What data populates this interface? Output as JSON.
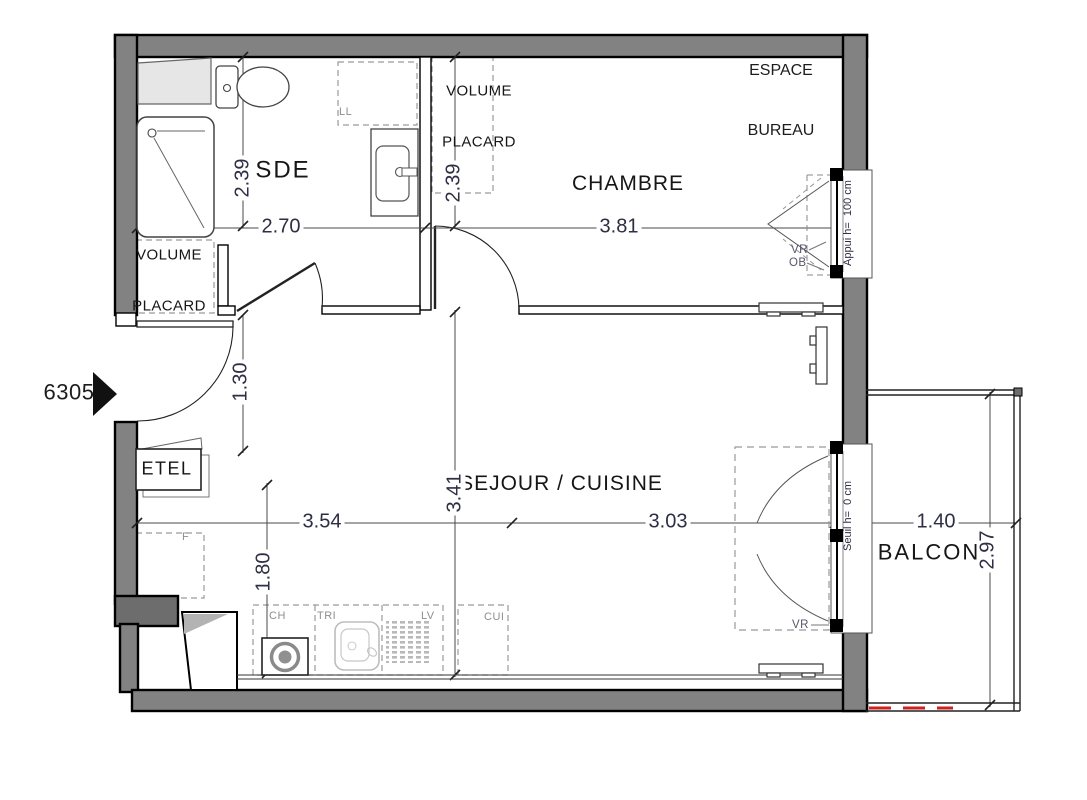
{
  "unit": {
    "number": "6305"
  },
  "rooms": {
    "sde": {
      "label": "SDE"
    },
    "chambre": {
      "label": "CHAMBRE"
    },
    "sejour": {
      "label": "SEJOUR / CUISINE"
    },
    "balcon": {
      "label": "BALCON"
    },
    "bureau": {
      "line1": "ESPACE",
      "line2": "BUREAU"
    }
  },
  "placards": {
    "sde": {
      "line1": "VOLUME",
      "line2": "PLACARD"
    },
    "chambre": {
      "line1": "VOLUME",
      "line2": "PLACARD"
    }
  },
  "dimensions": {
    "sde_width": "2.70",
    "sde_depth": "2.39",
    "placard_depth": "2.39",
    "chambre_width": "3.81",
    "entry_width": "1.30",
    "sejour_left": "3.54",
    "sejour_right": "3.03",
    "sejour_depth": "3.41",
    "kitchen_run": "1.80",
    "balcon_width": "1.40",
    "balcon_depth": "2.97"
  },
  "openings": {
    "window_sill": "Appui h=  100 cm",
    "door_threshold": "Seuil h=  0 cm",
    "roller_shutter": "VR",
    "tilt_window": "OB"
  },
  "equipment": {
    "electrical_panel": "ETEL",
    "washing_machine": "LL",
    "fridge": "F",
    "water_heater": "CH",
    "waste_sorting": "TRI",
    "dishwasher": "LV",
    "cooker": "CUI"
  },
  "colors": {
    "wall_fill": "#828282",
    "wall_dark": "#6d6d6d",
    "line": "#222222",
    "dim_text": "#2e2e44",
    "muted_label": "#8e8e8e",
    "tag_label": "#56566b",
    "red_dashed": "#cc2222"
  }
}
